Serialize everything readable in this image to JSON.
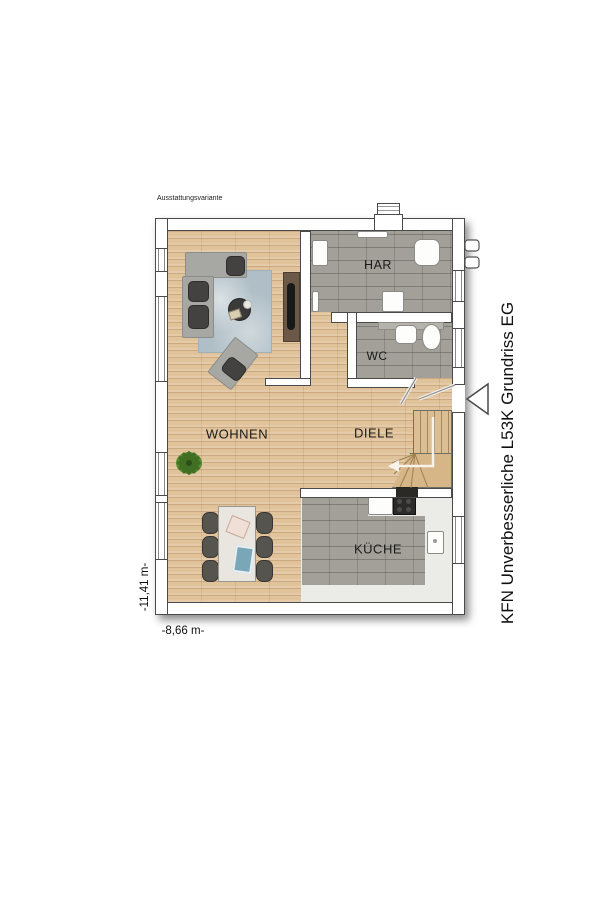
{
  "annotations": {
    "variant_label": "Ausstattungsvariante",
    "plan_title": "KFN Unverbesserliche L53K Grundriss EG",
    "width_dimension": "-8,66 m-",
    "height_dimension": "-11,41 m-"
  },
  "rooms": [
    {
      "id": "wohnen",
      "label": "WOHNEN",
      "floor": "wood"
    },
    {
      "id": "diele",
      "label": "DIELE",
      "floor": "wood"
    },
    {
      "id": "har",
      "label": "HAR",
      "floor": "tile"
    },
    {
      "id": "wc",
      "label": "WC",
      "floor": "tile"
    },
    {
      "id": "kueche",
      "label": "KÜCHE",
      "floor": "tile"
    }
  ],
  "colors": {
    "wood_floor": "#e0c29b",
    "tile_floor": "#a3a099",
    "kitchen_screed": "#ebebe7",
    "wall_fill": "#ffffff",
    "wall_outline": "#4a4a4a",
    "rug": "#b0bfc7",
    "sofa": "#a7a7a4",
    "plant": "#4a7d2c"
  },
  "furniture": [
    "corner-sofa",
    "armchair",
    "coffee-table",
    "area-rug",
    "tv-sideboard",
    "plant",
    "dining-table",
    "dining-chairs",
    "washing-machine",
    "heat-pump-unit",
    "wc-sink",
    "wc-toilet",
    "kitchen-counter",
    "cooktop",
    "kitchen-sink",
    "staircase"
  ]
}
